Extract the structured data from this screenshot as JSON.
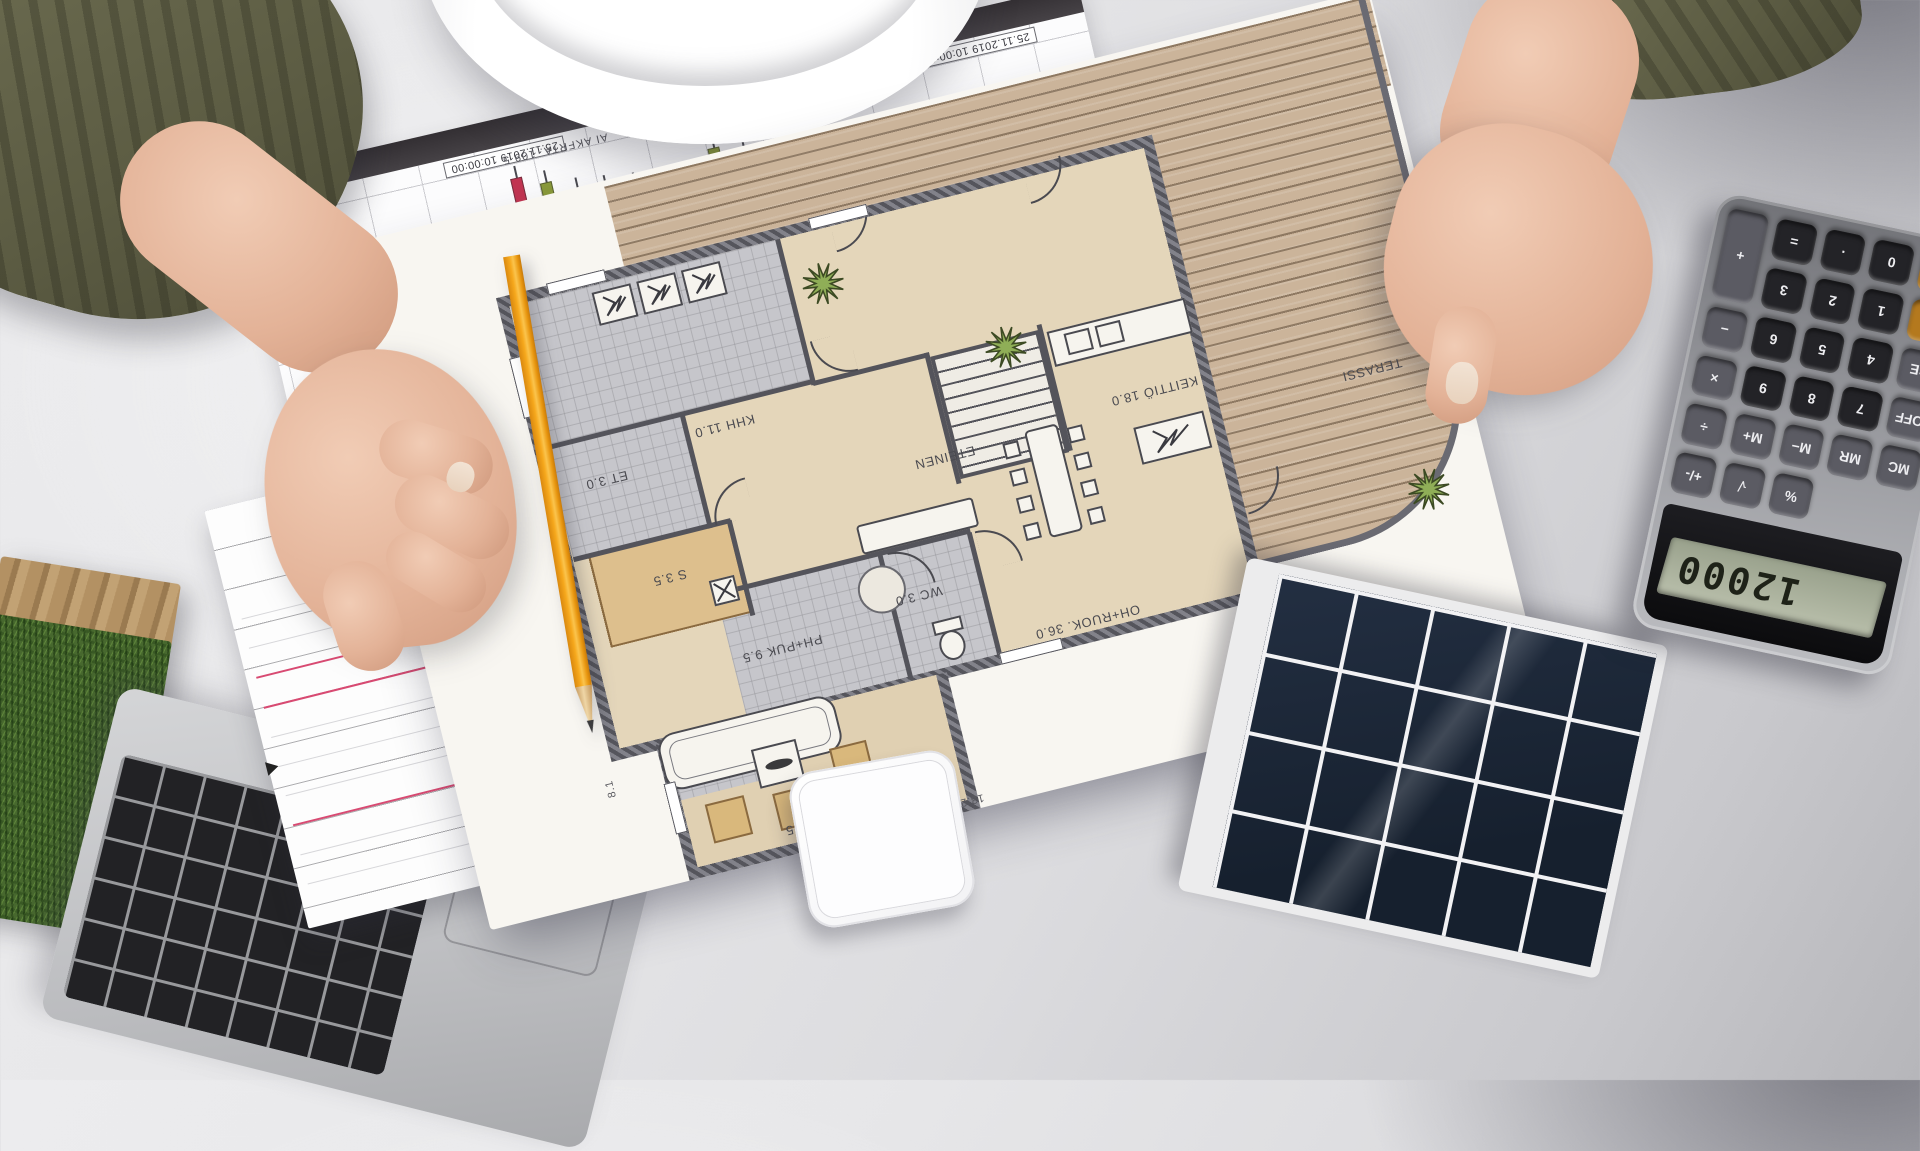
{
  "floor_plan": {
    "rooms": [
      {
        "id": "khh",
        "label": "KHH 11.0"
      },
      {
        "id": "et",
        "label": "ET 3.0"
      },
      {
        "id": "sauna",
        "label": "S 3.5"
      },
      {
        "id": "ph_puk",
        "label": "PH+PUK 9.5"
      },
      {
        "id": "wc",
        "label": "WC 3.0"
      },
      {
        "id": "eteinen",
        "label": "ETEINEN"
      },
      {
        "id": "keittio",
        "label": "KEITTIÖ 18.0"
      },
      {
        "id": "oh_ruok",
        "label": "OH+RUOK. 36.0"
      },
      {
        "id": "takkahuone",
        "label": "TAKKAHUONE 13.5"
      },
      {
        "id": "terassi",
        "label": "TERASSI"
      }
    ],
    "dimensions": [
      "8.1",
      "13.2"
    ]
  },
  "stock_chart": {
    "ticker_line": "AI AKFRTA. 109 5",
    "x_labels": [
      "25.11.2019 10:00:00",
      "10:00",
      "25.11.2019 10:00:00"
    ],
    "chart_data": {
      "type": "candlestick",
      "up_color": "#8a9a3a",
      "down_color": "#c23552",
      "candles": [
        {
          "x": 6,
          "dir": "up",
          "wick_top": 34,
          "wick_h": 40,
          "body_top": 46,
          "body_h": 20
        },
        {
          "x": 17,
          "dir": "up",
          "wick_top": 40,
          "wick_h": 38,
          "body_top": 54,
          "body_h": 18
        },
        {
          "x": 28,
          "dir": "down",
          "wick_top": 22,
          "wick_h": 46,
          "body_top": 30,
          "body_h": 26
        },
        {
          "x": 39,
          "dir": "up",
          "wick_top": 14,
          "wick_h": 52,
          "body_top": 24,
          "body_h": 30
        },
        {
          "x": 50,
          "dir": "down",
          "wick_top": 8,
          "wick_h": 62,
          "body_top": 16,
          "body_h": 36
        },
        {
          "x": 61,
          "dir": "up",
          "wick_top": 20,
          "wick_h": 52,
          "body_top": 32,
          "body_h": 24
        },
        {
          "x": 72,
          "dir": "down",
          "wick_top": 30,
          "wick_h": 44,
          "body_top": 40,
          "body_h": 18
        },
        {
          "x": 83,
          "dir": "up",
          "wick_top": 46,
          "wick_h": 36,
          "body_top": 58,
          "body_h": 16
        },
        {
          "x": 94,
          "dir": "down",
          "wick_top": 54,
          "wick_h": 34,
          "body_top": 62,
          "body_h": 18
        }
      ]
    }
  },
  "notepad": {
    "marker": "▼",
    "labels": {
      "prev_day_high": "Prev. Day High",
      "open": "Open",
      "close": "Close"
    }
  },
  "calculator": {
    "display": "12000",
    "keys": [
      {
        "label": "%",
        "type": "gray",
        "row": 1,
        "col": 3
      },
      {
        "label": "√",
        "type": "gray",
        "row": 1,
        "col": 4
      },
      {
        "label": "+/-",
        "type": "gray",
        "row": 1,
        "col": 5
      },
      {
        "label": "MC",
        "type": "gray",
        "row": 2,
        "col": 1
      },
      {
        "label": "MR",
        "type": "gray",
        "row": 2,
        "col": 2
      },
      {
        "label": "M−",
        "type": "gray",
        "row": 2,
        "col": 3
      },
      {
        "label": "M+",
        "type": "gray",
        "row": 2,
        "col": 4
      },
      {
        "label": "÷",
        "type": "gray",
        "row": 2,
        "col": 5
      },
      {
        "label": "OFF",
        "type": "gray",
        "row": 3,
        "col": 1
      },
      {
        "label": "7",
        "type": "dark",
        "row": 3,
        "col": 2
      },
      {
        "label": "8",
        "type": "dark",
        "row": 3,
        "col": 3
      },
      {
        "label": "9",
        "type": "dark",
        "row": 3,
        "col": 4
      },
      {
        "label": "×",
        "type": "gray",
        "row": 3,
        "col": 5
      },
      {
        "label": "CE",
        "type": "gray",
        "row": 4,
        "col": 1
      },
      {
        "label": "4",
        "type": "dark",
        "row": 4,
        "col": 2
      },
      {
        "label": "5",
        "type": "dark",
        "row": 4,
        "col": 3
      },
      {
        "label": "6",
        "type": "dark",
        "row": 4,
        "col": 4
      },
      {
        "label": "−",
        "type": "gray",
        "row": 4,
        "col": 5
      },
      {
        "label": "AC",
        "type": "orange",
        "row": 5,
        "col": 1
      },
      {
        "label": "1",
        "type": "dark",
        "row": 5,
        "col": 2
      },
      {
        "label": "2",
        "type": "dark",
        "row": 5,
        "col": 3
      },
      {
        "label": "3",
        "type": "dark",
        "row": 5,
        "col": 4
      },
      {
        "label": "+",
        "type": "gray",
        "row": 5,
        "col": 5,
        "rowspan": 2
      },
      {
        "label": "ON/C",
        "type": "orange",
        "row": 6,
        "col": 1
      },
      {
        "label": "0",
        "type": "dark",
        "row": 6,
        "col": 2
      },
      {
        "label": "·",
        "type": "dark",
        "row": 6,
        "col": 3
      },
      {
        "label": "=",
        "type": "dark",
        "row": 6,
        "col": 4
      }
    ]
  },
  "palette": {
    "sleeve": "#65654a",
    "pencil": "#f0a11f",
    "candle_up": "#8a9a3a",
    "candle_down": "#c23552",
    "note_accent": "#d84a72",
    "lcd": "#aab29b",
    "key_orange": "#b4791e",
    "deck": "#cbb49a",
    "floor": "#e4d6ba",
    "wet_room": "#c6c6cb",
    "wall": "#5a5a61",
    "grass": "#47682e",
    "solar_cell": "#1a2331"
  }
}
